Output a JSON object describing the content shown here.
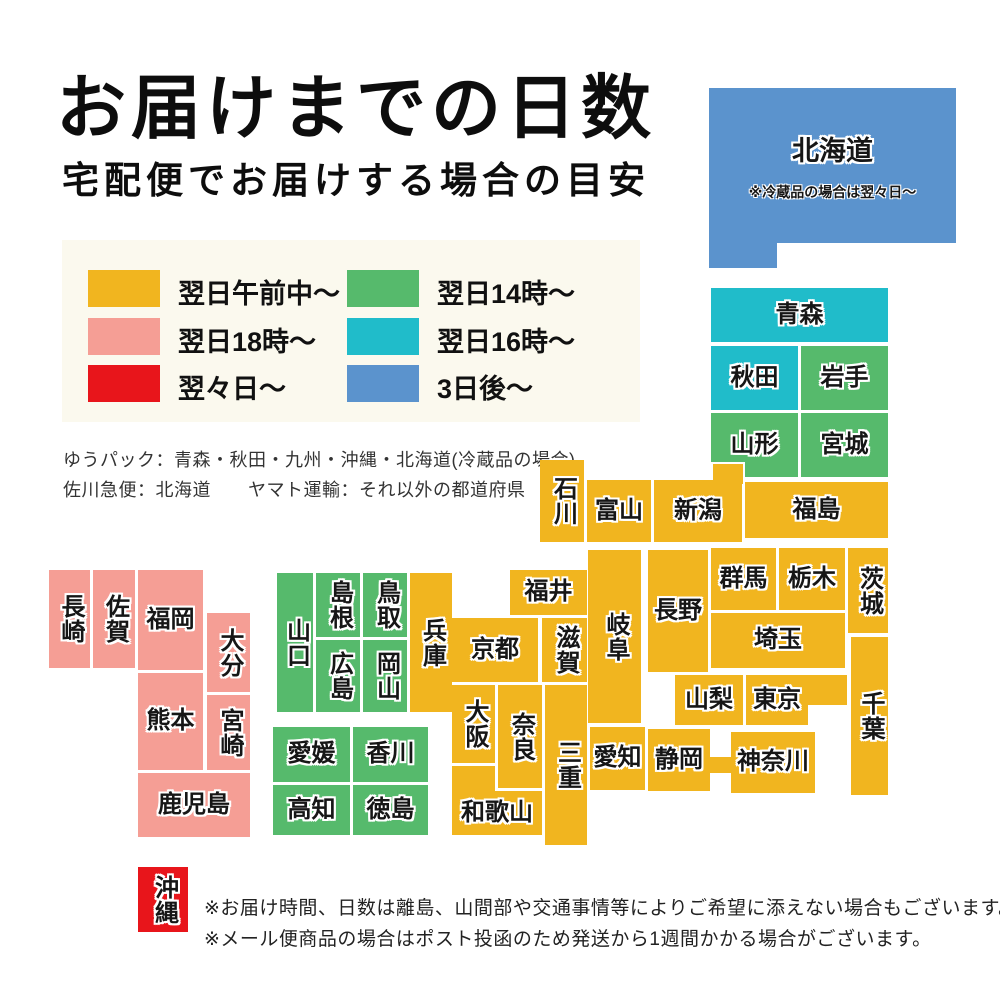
{
  "title": "お届けまでの日数",
  "subtitle": "宅配便でお届けする場合の目安",
  "colors": {
    "yellow": "#f1b51f",
    "pink": "#f59e95",
    "red": "#e8151b",
    "green": "#56ba6c",
    "cyan": "#20bcca",
    "blue": "#5b93cd",
    "legend_panel_bg": "#fbf9ee"
  },
  "legend": {
    "items": [
      {
        "label": "翌日午前中〜",
        "color_key": "yellow"
      },
      {
        "label": "翌日18時〜",
        "color_key": "pink"
      },
      {
        "label": "翌々日〜",
        "color_key": "red"
      },
      {
        "label": "翌日14時〜",
        "color_key": "green"
      },
      {
        "label": "翌日16時〜",
        "color_key": "cyan"
      },
      {
        "label": "3日後〜",
        "color_key": "blue"
      }
    ]
  },
  "carrier_notes": [
    "ゆうパック：青森・秋田・九州・沖縄・北海道(冷蔵品の場合)",
    "佐川急便：北海道　　ヤマト運輸：それ以外の都道府県"
  ],
  "hokkaido": {
    "name": "北海道",
    "note": "※冷蔵品の場合は翌々日〜",
    "color_key": "blue"
  },
  "map": {
    "blocks": [
      {
        "n": "青森",
        "x": 711,
        "y": 288,
        "w": 177,
        "h": 54,
        "c": "cyan"
      },
      {
        "n": "秋田",
        "x": 711,
        "y": 346,
        "w": 87,
        "h": 64,
        "c": "cyan"
      },
      {
        "n": "岩手",
        "x": 801,
        "y": 346,
        "w": 87,
        "h": 64,
        "c": "green"
      },
      {
        "n": "山形",
        "x": 711,
        "y": 413,
        "w": 87,
        "h": 64,
        "c": "green"
      },
      {
        "n": "宮城",
        "x": 801,
        "y": 413,
        "w": 87,
        "h": 64,
        "c": "green"
      },
      {
        "n": "",
        "x": 711,
        "y": 462,
        "w": 30,
        "h": 20,
        "c": "yellow",
        "edge": 1
      },
      {
        "n": "石川",
        "x": 540,
        "y": 460,
        "w": 44,
        "h": 82,
        "c": "yellow",
        "v": 1
      },
      {
        "n": "富山",
        "x": 587,
        "y": 480,
        "w": 64,
        "h": 62,
        "c": "yellow"
      },
      {
        "n": "新潟",
        "x": 654,
        "y": 480,
        "w": 88,
        "h": 62,
        "c": "yellow"
      },
      {
        "n": "福島",
        "x": 745,
        "y": 482,
        "w": 143,
        "h": 56,
        "c": "yellow"
      },
      {
        "n": "群馬",
        "x": 711,
        "y": 548,
        "w": 65,
        "h": 62,
        "c": "yellow"
      },
      {
        "n": "栃木",
        "x": 779,
        "y": 548,
        "w": 66,
        "h": 62,
        "c": "yellow"
      },
      {
        "n": "茨城",
        "x": 848,
        "y": 548,
        "w": 40,
        "h": 85,
        "c": "yellow",
        "v": 1
      },
      {
        "n": "埼玉",
        "x": 711,
        "y": 613,
        "w": 134,
        "h": 55,
        "c": "yellow"
      },
      {
        "n": "長野",
        "x": 648,
        "y": 550,
        "w": 60,
        "h": 122,
        "c": "yellow"
      },
      {
        "n": "岐阜",
        "x": 588,
        "y": 550,
        "w": 53,
        "h": 173,
        "c": "yellow",
        "v": 1
      },
      {
        "n": "山梨",
        "x": 675,
        "y": 675,
        "w": 68,
        "h": 50,
        "c": "yellow"
      },
      {
        "n": "",
        "x": 806,
        "y": 675,
        "w": 41,
        "h": 30,
        "c": "yellow"
      },
      {
        "n": "東京",
        "x": 746,
        "y": 675,
        "w": 62,
        "h": 50,
        "c": "yellow"
      },
      {
        "n": "千葉",
        "x": 851,
        "y": 637,
        "w": 37,
        "h": 158,
        "c": "yellow",
        "v": 1
      },
      {
        "n": "",
        "x": 706,
        "y": 757,
        "w": 28,
        "h": 16,
        "c": "yellow"
      },
      {
        "n": "神奈川",
        "x": 731,
        "y": 732,
        "w": 84,
        "h": 61,
        "c": "yellow"
      },
      {
        "n": "静岡",
        "x": 648,
        "y": 729,
        "w": 62,
        "h": 62,
        "c": "yellow"
      },
      {
        "n": "愛知",
        "x": 590,
        "y": 727,
        "w": 55,
        "h": 63,
        "c": "yellow"
      },
      {
        "n": "福井",
        "x": 510,
        "y": 570,
        "w": 77,
        "h": 45,
        "c": "yellow"
      },
      {
        "n": "京都",
        "x": 452,
        "y": 618,
        "w": 86,
        "h": 64,
        "c": "yellow"
      },
      {
        "n": "滋賀",
        "x": 542,
        "y": 618,
        "w": 45,
        "h": 64,
        "c": "yellow",
        "v": 1
      },
      {
        "n": "大阪",
        "x": 452,
        "y": 685,
        "w": 43,
        "h": 78,
        "c": "yellow",
        "v": 1
      },
      {
        "n": "奈良",
        "x": 498,
        "y": 685,
        "w": 44,
        "h": 103,
        "c": "yellow",
        "v": 1
      },
      {
        "n": "三重",
        "x": 545,
        "y": 685,
        "w": 42,
        "h": 160,
        "c": "yellow",
        "v": 1
      },
      {
        "n": "",
        "x": 452,
        "y": 766,
        "w": 43,
        "h": 69,
        "c": "yellow"
      },
      {
        "n": "和歌山",
        "x": 452,
        "y": 791,
        "w": 90,
        "h": 44,
        "c": "yellow"
      },
      {
        "n": "兵庫",
        "x": 410,
        "y": 573,
        "w": 42,
        "h": 139,
        "c": "yellow",
        "v": 1
      },
      {
        "n": "山口",
        "x": 277,
        "y": 573,
        "w": 36,
        "h": 139,
        "c": "green",
        "v": 1
      },
      {
        "n": "島根",
        "x": 316,
        "y": 573,
        "w": 44,
        "h": 64,
        "c": "green",
        "v": 1
      },
      {
        "n": "鳥取",
        "x": 363,
        "y": 573,
        "w": 44,
        "h": 64,
        "c": "green",
        "v": 1
      },
      {
        "n": "広島",
        "x": 316,
        "y": 640,
        "w": 44,
        "h": 72,
        "c": "green",
        "v": 1
      },
      {
        "n": "岡山",
        "x": 363,
        "y": 640,
        "w": 44,
        "h": 72,
        "c": "green",
        "v": 1
      },
      {
        "n": "愛媛",
        "x": 273,
        "y": 727,
        "w": 77,
        "h": 55,
        "c": "green"
      },
      {
        "n": "香川",
        "x": 353,
        "y": 727,
        "w": 75,
        "h": 55,
        "c": "green"
      },
      {
        "n": "高知",
        "x": 273,
        "y": 785,
        "w": 77,
        "h": 50,
        "c": "green"
      },
      {
        "n": "徳島",
        "x": 353,
        "y": 785,
        "w": 75,
        "h": 50,
        "c": "green"
      },
      {
        "n": "長崎",
        "x": 49,
        "y": 570,
        "w": 41,
        "h": 98,
        "c": "pink",
        "v": 1
      },
      {
        "n": "佐賀",
        "x": 93,
        "y": 570,
        "w": 42,
        "h": 98,
        "c": "pink",
        "v": 1
      },
      {
        "n": "福岡",
        "x": 138,
        "y": 570,
        "w": 65,
        "h": 100,
        "c": "pink"
      },
      {
        "n": "大分",
        "x": 207,
        "y": 613,
        "w": 43,
        "h": 79,
        "c": "pink",
        "v": 1
      },
      {
        "n": "熊本",
        "x": 138,
        "y": 673,
        "w": 65,
        "h": 97,
        "c": "pink"
      },
      {
        "n": "宮崎",
        "x": 207,
        "y": 695,
        "w": 43,
        "h": 75,
        "c": "pink",
        "v": 1
      },
      {
        "n": "鹿児島",
        "x": 138,
        "y": 773,
        "w": 112,
        "h": 64,
        "c": "pink"
      },
      {
        "n": "沖縄",
        "x": 138,
        "y": 867,
        "w": 50,
        "h": 65,
        "c": "red",
        "v": 1
      }
    ]
  },
  "footer_notes": [
    "※お届け時間、日数は離島、山間部や交通事情等によりご希望に添えない場合もございます。",
    "※メール便商品の場合はポスト投函のため発送から1週間かかる場合がございます。"
  ]
}
